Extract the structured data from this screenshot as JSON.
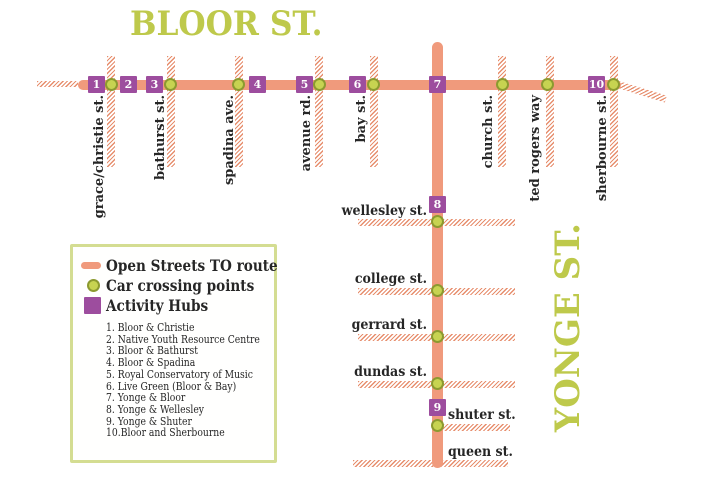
{
  "titles": {
    "bloor_street": "BLOOR ST.",
    "yonge_street": "YONGE ST."
  },
  "bloor_cross_streets": [
    "grace/christie st.",
    "bathurst st.",
    "spadina ave.",
    "avenue rd.",
    "bay st.",
    "church st.",
    "ted rogers way",
    "sherbourne st."
  ],
  "yonge_cross_streets": [
    "wellesley st.",
    "college st.",
    "gerrard st.",
    "dundas st.",
    "shuter st.",
    "queen st."
  ],
  "hub_numbers": [
    "1",
    "2",
    "3",
    "4",
    "5",
    "6",
    "7",
    "8",
    "9",
    "10"
  ],
  "legend": {
    "route_label": "Open Streets TO route",
    "crossings_label": "Car crossing points",
    "hubs_label": "Activity Hubs",
    "hub_list": [
      {
        "num": "1.",
        "name": "Bloor & Christie"
      },
      {
        "num": "2.",
        "name": "Native Youth Resource Centre"
      },
      {
        "num": "3.",
        "name": "Bloor & Bathurst"
      },
      {
        "num": "4.",
        "name": "Bloor & Spadina"
      },
      {
        "num": "5.",
        "name": "Royal Conservatory of Music"
      },
      {
        "num": "6.",
        "name": "Live Green (Bloor & Bay)"
      },
      {
        "num": "7.",
        "name": "Yonge & Bloor"
      },
      {
        "num": "8.",
        "name": "Yonge & Wellesley"
      },
      {
        "num": "9.",
        "name": "Yonge & Shuter"
      },
      {
        "num": "10.",
        "name": "Bloor and Sherbourne"
      }
    ]
  },
  "colors": {
    "route": "#F09A7C",
    "hatch": "#E78E6D",
    "crossing_fill": "#C7D351",
    "crossing_border": "#8C9A30",
    "activity_hub": "#9D4D9E",
    "street_title": "#BEC94B",
    "legend_border": "#D4DD92",
    "text": "#262626"
  }
}
